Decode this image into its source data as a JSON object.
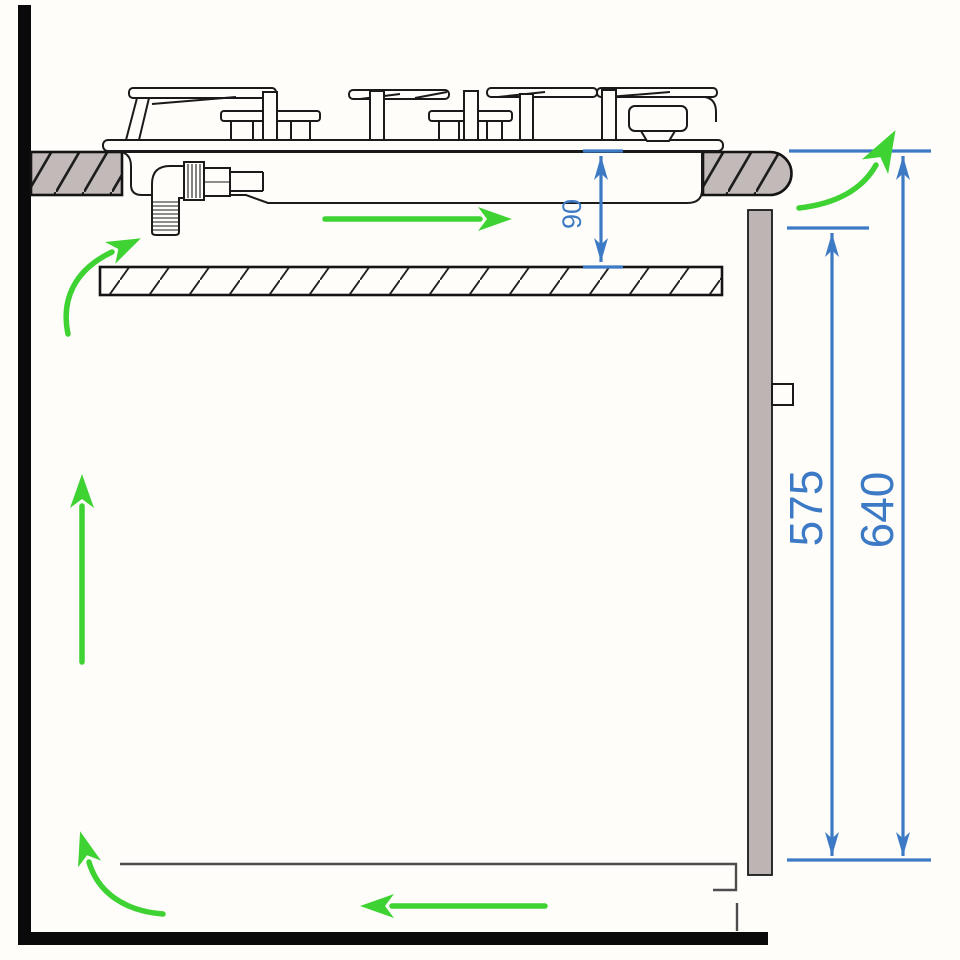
{
  "title": "Gas hob built-in installation clearances — side section diagram",
  "dimensions": {
    "gap_90": {
      "value": "90"
    },
    "panel_575": {
      "value": "575"
    },
    "worktop_640": {
      "value": "640"
    }
  },
  "components": [
    "wall",
    "floor",
    "worktop-left",
    "worktop-right-bullnose",
    "heat-shield-shelf",
    "rear-panel",
    "rear-panel-bracket",
    "base-cabinet-outline",
    "hob-top-plate",
    "hob-tub",
    "gas-inlet-elbow",
    "pan-supports",
    "burners"
  ],
  "airflow_arrows": [
    {
      "name": "under-hob-right-arrow",
      "direction": "right"
    },
    {
      "name": "below-counter-curved-arrow",
      "direction": "up-right"
    },
    {
      "name": "cabinet-interior-up-arrow",
      "direction": "up"
    },
    {
      "name": "bottom-left-curved-arrow",
      "direction": "up-left"
    },
    {
      "name": "bottom-inflow-left-arrow",
      "direction": "left"
    },
    {
      "name": "worktop-rear-curved-arrow",
      "direction": "up-right"
    }
  ],
  "colors": {
    "dimension_blue": "#3d7ac5",
    "airflow_green": "#3ed233",
    "counter_fill": "#c2b9b9",
    "panel_fill": "#bdb4b4",
    "wall_black": "#0a0a0a",
    "cabinet_gray": "#4d4d4d",
    "background": "#fffdfa"
  }
}
